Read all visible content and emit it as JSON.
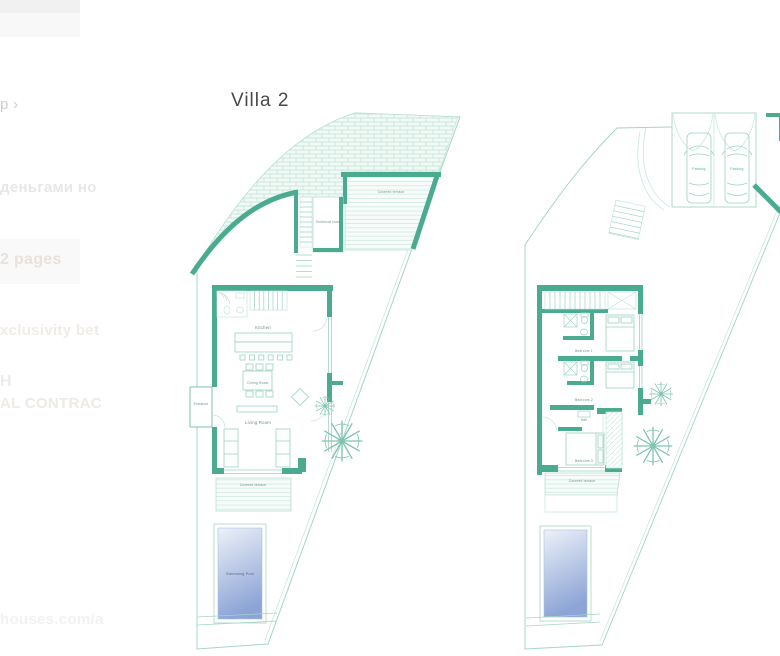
{
  "header": {
    "title": "Villa 2"
  },
  "sidebar_fragments": {
    "breadcrumb": "p ›",
    "line1": "деньгами но",
    "line2": "2 pages",
    "line3": "xclusivity bet",
    "line4": "H",
    "line5": "AL CONTRAC",
    "footer_url": "houses.com/a"
  },
  "ground_floor": {
    "labels": {
      "upper_terrace": "Covered terrace",
      "technical_room": "Technical room",
      "kitchen": "Kitchen",
      "dining_room": "Dining Room",
      "living_room": "Living Room",
      "entrance": "Entrance",
      "lower_terrace": "Covered terrace",
      "swimming_pool": "Swimming Pool"
    }
  },
  "first_floor": {
    "labels": {
      "parking": "Parking",
      "bedroom_1": "Bedroom 1",
      "bedroom_2": "Bedroom 2",
      "hall": "Hall",
      "bedroom_3": "Bedroom 3",
      "terrace": "Covered terrace"
    }
  },
  "colors": {
    "wall_teal": "#4BAB90",
    "thin_line": "#A5D5C5",
    "label_text": "#6B8A7F",
    "pool_top": "#EDF1F8",
    "pool_bottom": "#8CA4D6",
    "title_text": "#4A4A4A"
  }
}
